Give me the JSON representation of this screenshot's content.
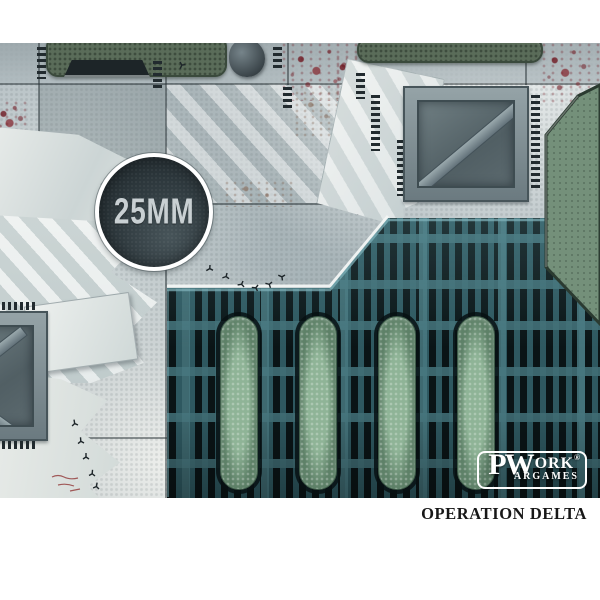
{
  "image": {
    "description": "Sci-fi industrial floor wargaming mat preview photo",
    "badge": {
      "label": "25MM"
    },
    "brand": {
      "p": "P",
      "w": "W",
      "ork": "ORK",
      "registered": "®",
      "wargames_suffix": "ARGAMES"
    },
    "caption": {
      "title": "OPERATION DELTA"
    },
    "palette": {
      "page_background": "#ffffff",
      "concrete_light": "#e7ebe9",
      "concrete_mid": "#b7c1c5",
      "concrete_dark": "#8b989b",
      "pad_green_dark": "#5a6c59",
      "octagon_green": "#74907a",
      "pill_green": "#84aa8c",
      "grate_teal": "#2e5860",
      "grate_slot": "#0a1416",
      "blood_red": "#6f1f27",
      "badge_fill": "#2a3438",
      "badge_text": "#c9d0d3",
      "logo_white": "#ffffff",
      "caption_black": "#171717"
    }
  }
}
